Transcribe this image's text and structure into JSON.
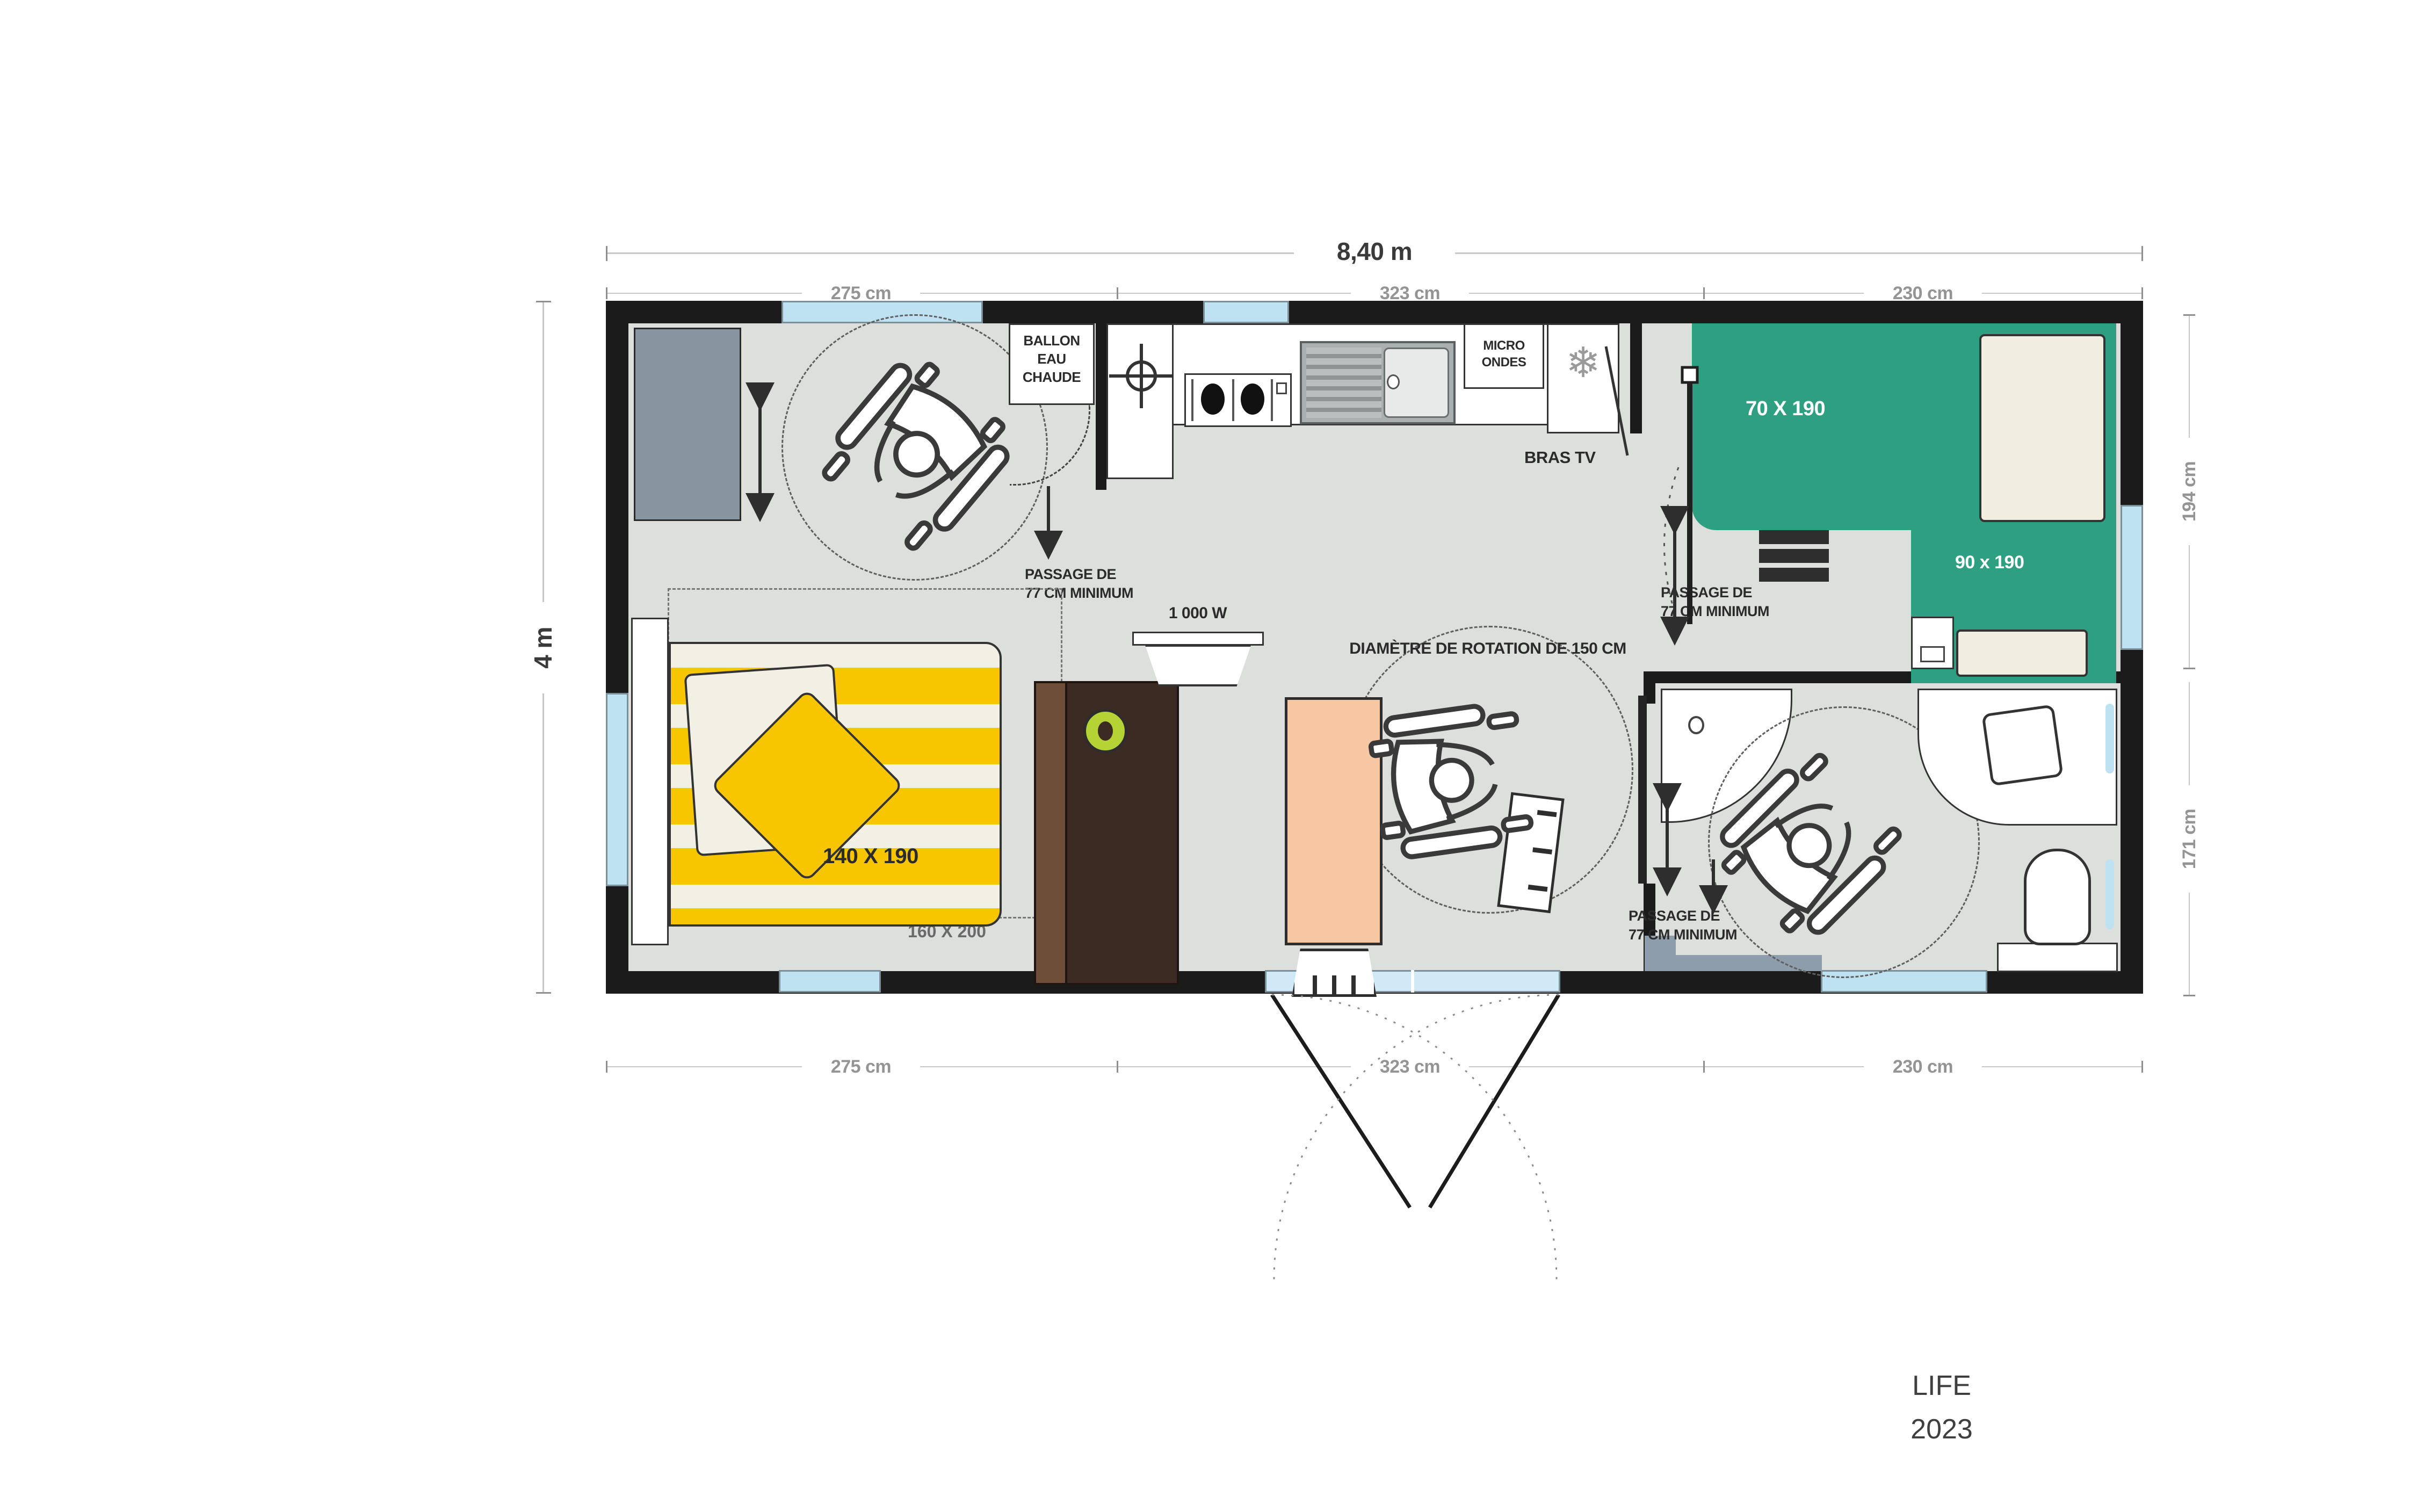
{
  "title": {
    "model": "LIFE",
    "year": "2023"
  },
  "dimensions": {
    "total_width": "8,40 m",
    "total_height": "4 m",
    "top_segments": [
      "275 cm",
      "323 cm",
      "230 cm"
    ],
    "bottom_segments": [
      "275 cm",
      "323 cm",
      "230 cm"
    ],
    "right_segments": [
      "194 cm",
      "171 cm"
    ]
  },
  "labels": {
    "water_heater_l1": "BALLON",
    "water_heater_l2": "EAU",
    "water_heater_l3": "CHAUDE",
    "microwave_l1": "MICRO",
    "microwave_l2": "ONDES",
    "tv_arm": "BRAS TV",
    "passage_l1": "PASSAGE DE",
    "passage_l2": "77 CM MINIMUM",
    "rotation_diameter": "DIAMÈTRE DE ROTATION DE 150 CM",
    "heater_power": "1 000 W"
  },
  "beds": {
    "double": "140 X 190",
    "double_zone": "160 X 200",
    "single_top": "70 X 190",
    "single_right": "90 x 190"
  },
  "icons": {
    "snowflake": "❄"
  },
  "colors": {
    "bed_green": "#2f9f82",
    "bed_yellow": "#f7c600",
    "table_peach": "#f7c7a3",
    "cabinet_brown": "#3b2b23",
    "wardrobe_slate": "#8795a1",
    "window_blue": "#bfe2f2",
    "floor_grey": "#dcdfdb",
    "knob_lime": "#b5d334"
  }
}
